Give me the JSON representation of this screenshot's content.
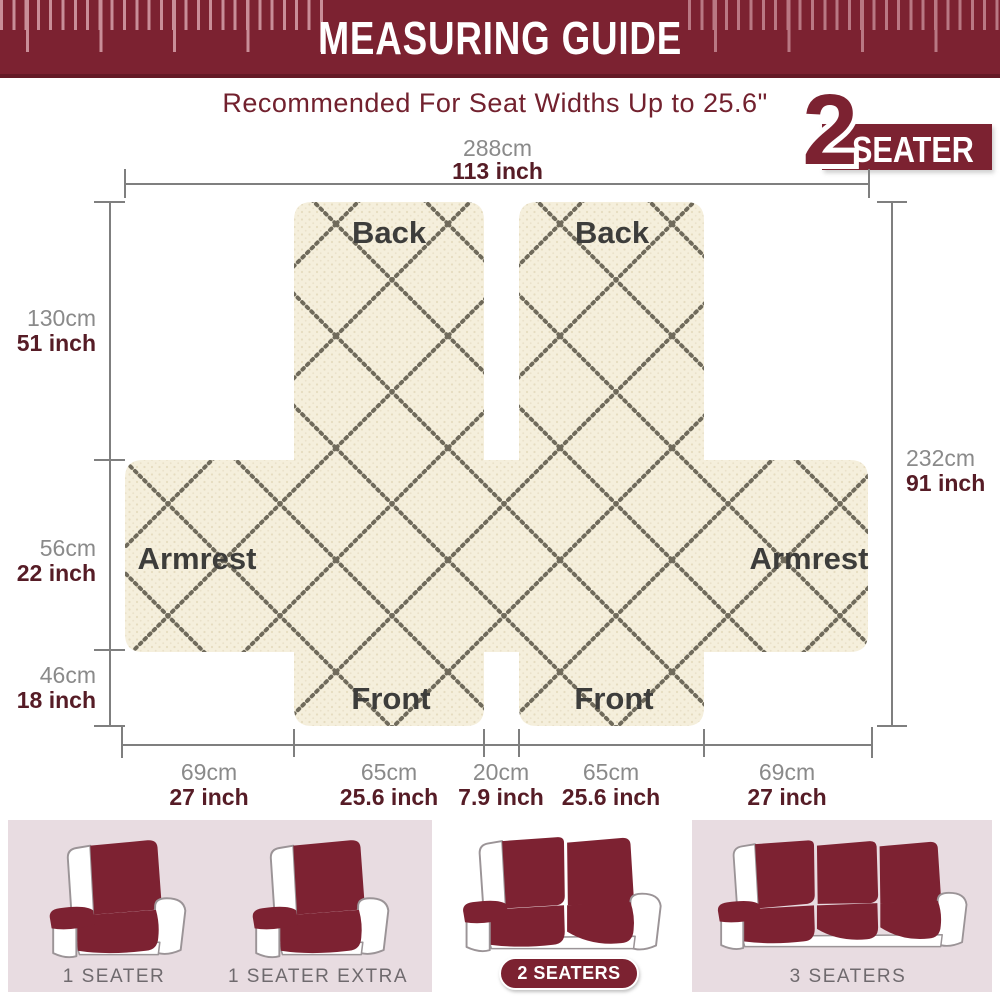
{
  "header": {
    "title": "MEASURING GUIDE"
  },
  "subtitle": "Recommended For Seat Widths Up to 25.6\"",
  "badge": {
    "number": "2",
    "label": "SEATER"
  },
  "diagram": {
    "top": {
      "cm": "288cm",
      "inch": "113 inch"
    },
    "right": {
      "cm": "232cm",
      "inch": "91 inch"
    },
    "left": [
      {
        "cm": "130cm",
        "inch": "51 inch"
      },
      {
        "cm": "56cm",
        "inch": "22 inch"
      },
      {
        "cm": "46cm",
        "inch": "18 inch"
      }
    ],
    "bottom": [
      {
        "cm": "69cm",
        "inch": "27 inch"
      },
      {
        "cm": "65cm",
        "inch": "25.6 inch"
      },
      {
        "cm": "20cm",
        "inch": "7.9 inch"
      },
      {
        "cm": "65cm",
        "inch": "25.6 inch"
      },
      {
        "cm": "69cm",
        "inch": "27 inch"
      }
    ],
    "labels": {
      "back_left": "Back",
      "back_right": "Back",
      "armrest_left": "Armrest",
      "armrest_right": "Armrest",
      "front_left": "Front",
      "front_right": "Front"
    }
  },
  "variants": [
    {
      "label": "1 SEATER",
      "selected": false
    },
    {
      "label": "1 SEATER EXTRA",
      "selected": false
    },
    {
      "label": "2 SEATERS",
      "selected": true
    },
    {
      "label": "3 SEATERS",
      "selected": false
    }
  ],
  "colors": {
    "maroon": "#7C2231",
    "dark_maroon_text": "#561C26",
    "cream_fabric": "#F5EFDC",
    "pattern_dot": "#4E4A3C",
    "pink_panel": "#E8DCE1",
    "tick_pink": "#C98E98",
    "line_gray": "#7F7F7F",
    "label_gray": "#6F6A6E"
  }
}
